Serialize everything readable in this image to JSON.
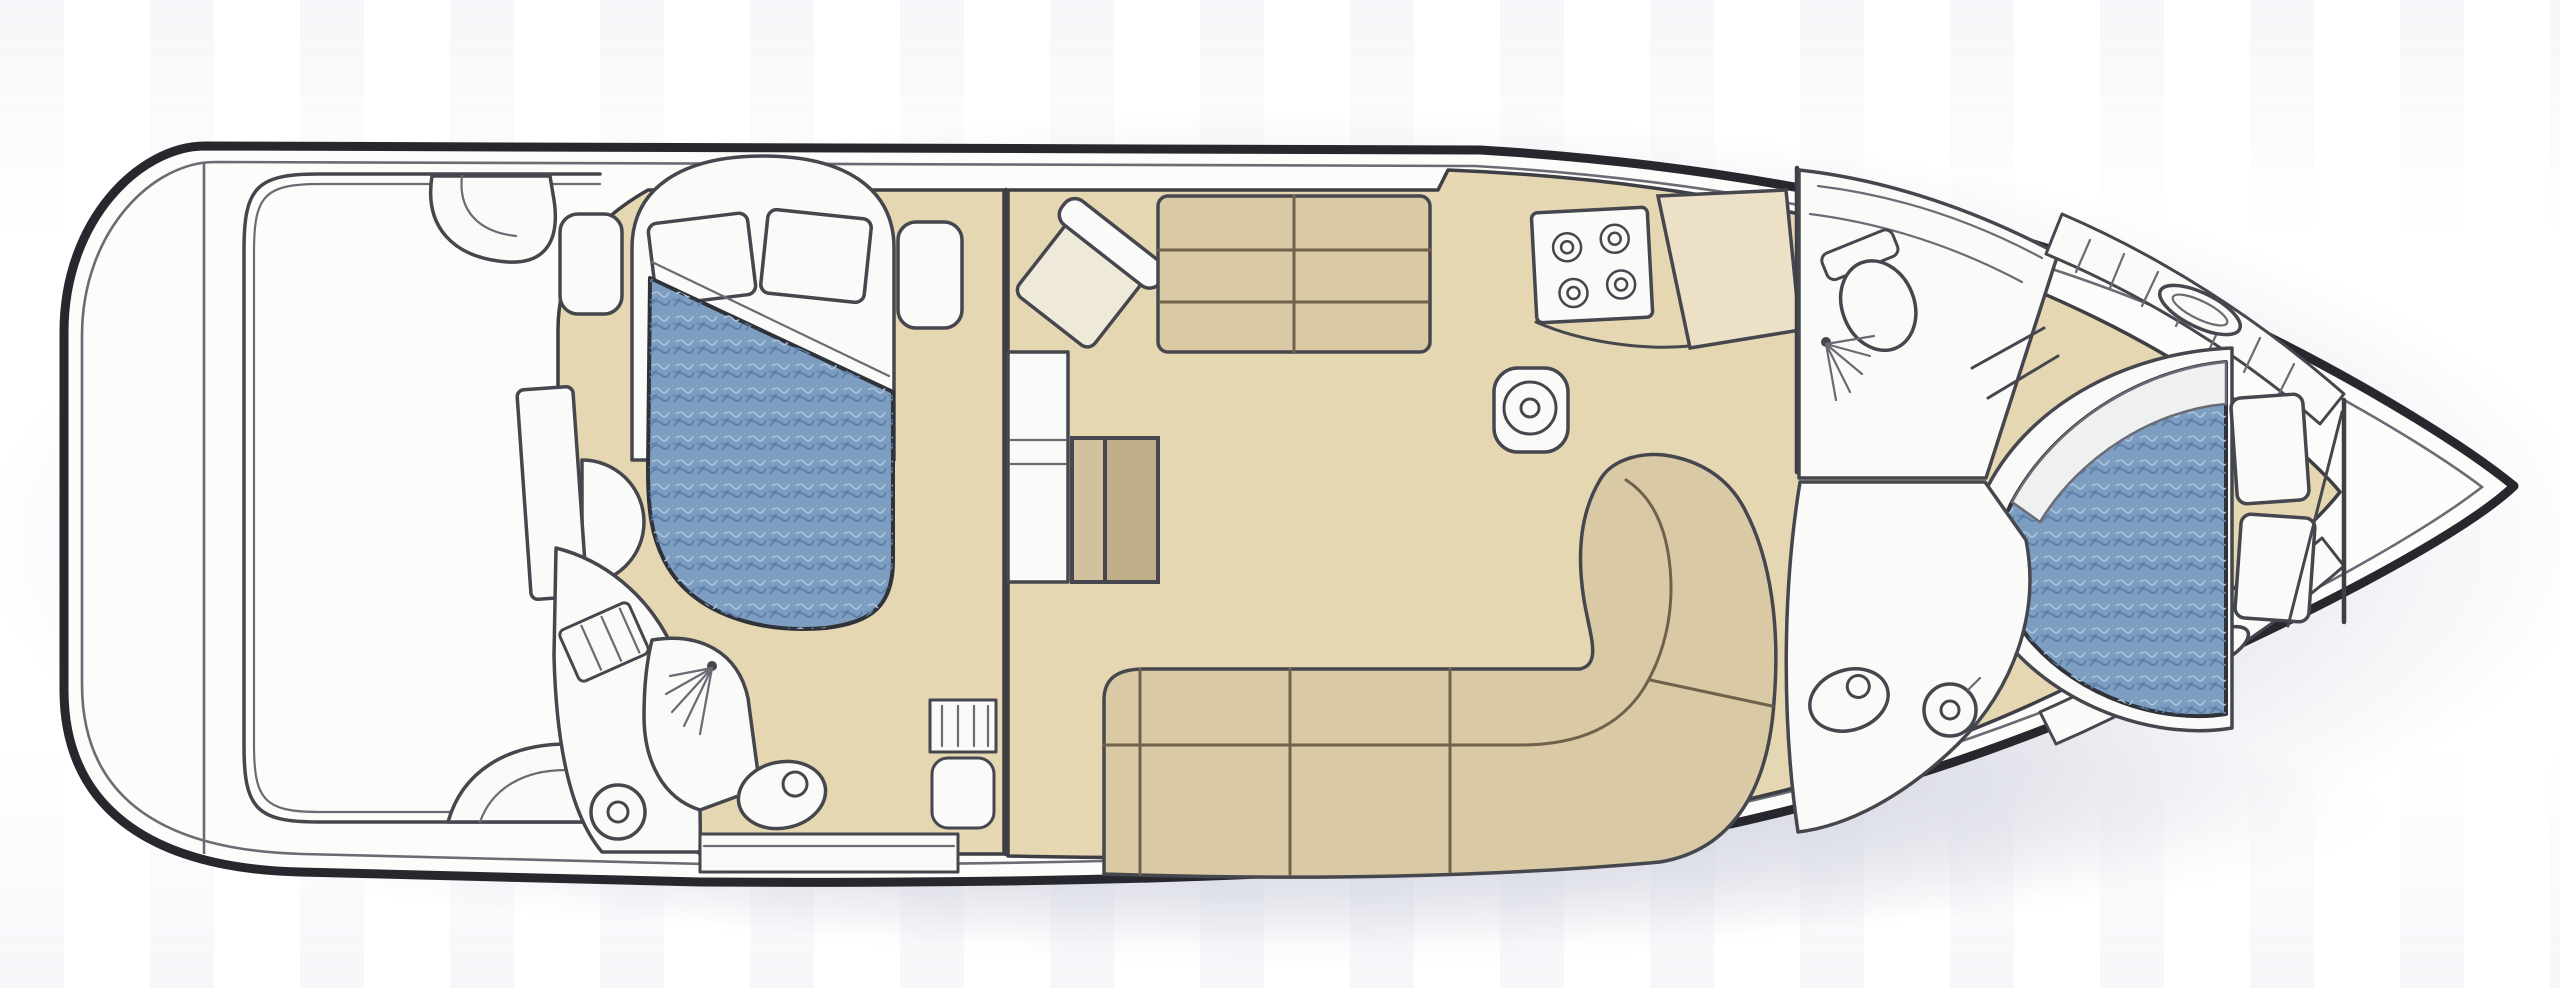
{
  "figure": {
    "kind": "yacht-interior-floor-plan",
    "view": "top-down",
    "orientation": {
      "bow": "right",
      "stern": "left"
    },
    "visible_text": []
  },
  "palette": {
    "background": "#ffffff",
    "backdrop_shadow": "#9fa3bc",
    "hull_fill": "#fcfcfa",
    "hull_stroke": "#27282e",
    "line": "#46474e",
    "line_soft": "#6a6b74",
    "wall": "#3e3f45",
    "seam": "#6f614b",
    "floor_tan": "#e5d7b2",
    "counter_cream": "#ece1c6",
    "upholstery_tan": "#d9c9a4",
    "upholstery_tan_light": "#e0d3b0",
    "wood_table_light": "#d2c19e",
    "wood_table_dark": "#bfae89",
    "bed_blue": "#7d9ec0",
    "bed_blue_deep": "#5d80a8",
    "bed_blue_pale": "#a9c2da",
    "bed_stroke": "#30323a",
    "linen_white": "#fafaf8",
    "sheet_white": "#eff1f1",
    "chair_fill": "#efe9da"
  },
  "rooms": [
    {
      "id": "aft-cockpit",
      "type": "deck",
      "features": [
        "coaming",
        "bench-seat",
        "wet-bar-seat",
        "companionway-door",
        "entry-step"
      ]
    },
    {
      "id": "aft-stateroom",
      "type": "cabin",
      "features": [
        "double-berth",
        "two-pillows",
        "headboard",
        "nightstand-port",
        "nightstand-starboard",
        "steps-down"
      ]
    },
    {
      "id": "aft-head",
      "type": "bathroom",
      "features": [
        "shower-stall",
        "toilet",
        "round-sink",
        "vanity-counter",
        "faucet-panel"
      ]
    },
    {
      "id": "salon",
      "type": "living",
      "features": [
        "loveseat-sofa",
        "swivel-chair",
        "cabinet-table",
        "u-shaped-settee",
        "entry-steps"
      ]
    },
    {
      "id": "galley",
      "type": "kitchen",
      "features": [
        "four-burner-cooktop",
        "round-sink",
        "counter-slab"
      ]
    },
    {
      "id": "mid-head",
      "type": "bathroom",
      "features": [
        "toilet",
        "shower-spray",
        "shelves"
      ]
    },
    {
      "id": "forward-stateroom",
      "type": "cabin",
      "features": [
        "island-berth",
        "two-pillows",
        "hanging-lockers",
        "deck-hatch-top",
        "deck-hatch-bottom",
        "entry-steps"
      ]
    },
    {
      "id": "forward-head",
      "type": "bathroom",
      "features": [
        "toilet",
        "round-sink"
      ]
    },
    {
      "id": "bow-locker",
      "type": "storage",
      "features": [
        "anchor-locker-bulkhead"
      ]
    }
  ]
}
